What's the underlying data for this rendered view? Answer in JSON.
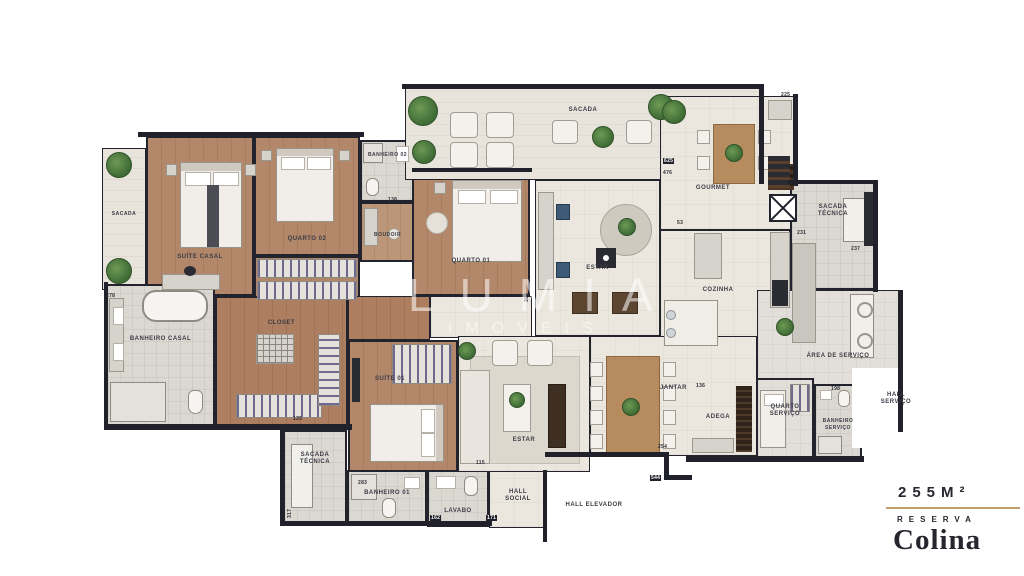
{
  "watermark": {
    "brand": "LUMIA",
    "sub": "IMOVEIS"
  },
  "badge": {
    "area": "255M²",
    "line1": "RESERVA",
    "line2": "Colina"
  },
  "rooms": {
    "sacadaLeft": {
      "label": "SACADA"
    },
    "suiteCasal": {
      "label": "SUÍTE CASAL"
    },
    "quarto02": {
      "label": "QUARTO 02"
    },
    "banheiro02": {
      "label": "BANHEIRO 02"
    },
    "boudoir": {
      "label": "BOUDOIR"
    },
    "quarto01": {
      "label": "QUARTO 01"
    },
    "closet": {
      "label": "CLOSET"
    },
    "banheiroCasal": {
      "label": "BANHEIRO CASAL"
    },
    "suite01": {
      "label": "SUÍTE 01"
    },
    "sacadaTecnicaSW": {
      "label": "SACADA TÉCNICA"
    },
    "banheiro01": {
      "label": "BANHEIRO 01"
    },
    "lavabo": {
      "label": "LAVABO"
    },
    "hallSocial": {
      "label": "HALL SOCIAL"
    },
    "hallElevador": {
      "label": "HALL ELEVADOR"
    },
    "sacadaTop": {
      "label": "SACADA"
    },
    "gourmet": {
      "label": "GOURMET"
    },
    "estarUpper": {
      "label": "ESTAR"
    },
    "cozinha": {
      "label": "COZINHA"
    },
    "sacadaTecnicaNE": {
      "label": "SACADA TÉCNICA"
    },
    "areaServico": {
      "label": "ÁREA DE SERVIÇO"
    },
    "adega": {
      "label": "ADEGA"
    },
    "quartoServico": {
      "label": "QUARTO SERVIÇO"
    },
    "banheiroServico": {
      "label": "BANHEIRO SERVIÇO"
    },
    "hallServico": {
      "label": "HALL SERVIÇO"
    },
    "estarLower": {
      "label": "ESTAR"
    },
    "jantar": {
      "label": "JANTAR"
    }
  },
  "dimensions": [
    "278",
    "625",
    "476",
    "225",
    "231",
    "237",
    "53",
    "390",
    "138",
    "283",
    "317",
    "125",
    "115",
    "171",
    "162",
    "136",
    "198",
    "254",
    "544"
  ],
  "colors": {
    "wall": "#21212b",
    "wood": "#b2876a",
    "tile": "#ece7de",
    "accentGold": "#c2a06b",
    "brandInk": "#26262f"
  }
}
